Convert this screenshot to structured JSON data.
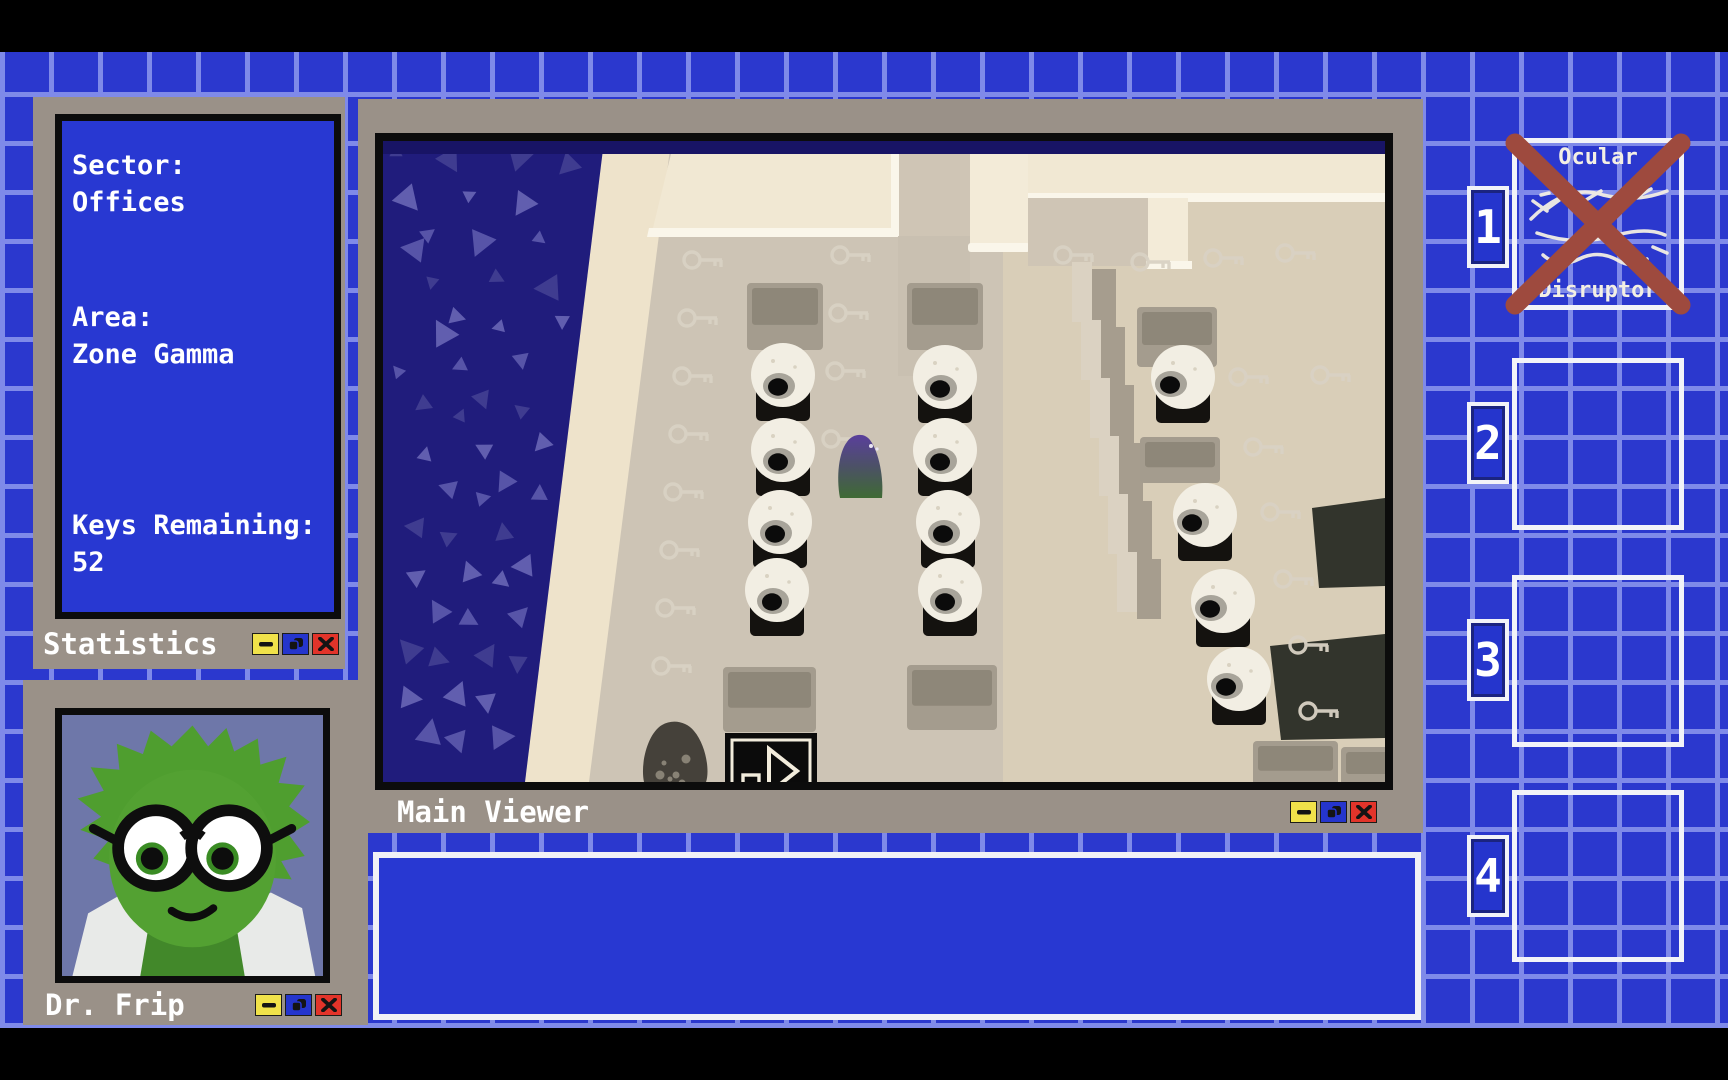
{
  "colors": {
    "grid_tile_blue": "#2b38ce",
    "grid_line_blue": "#7f8ae9",
    "window_frame_gray": "#9a9188",
    "panel_blue": "#2838d2",
    "button_yellow": "#f0e24a",
    "button_blue": "#2535cd",
    "button_red": "#e2342a",
    "crossout_red": "#9e4a3e",
    "portrait_background": "#6e77a9"
  },
  "windows": {
    "statistics": {
      "title": "Statistics",
      "fields": [
        {
          "label": "Sector:",
          "value": "Offices"
        },
        {
          "label": "Area:",
          "value": "Zone Gamma"
        },
        {
          "label": "Keys Remaining:",
          "value": "52"
        }
      ]
    },
    "portrait": {
      "title": "Dr. Frip"
    },
    "viewer": {
      "title": "Main Viewer"
    },
    "message": {
      "text": ""
    }
  },
  "window_controls": {
    "minimize": "—",
    "restore": "❐",
    "close": "✕"
  },
  "inventory": {
    "slots": [
      {
        "number": "1",
        "item": {
          "name": "Ocular Disruptor",
          "line1": "Ocular",
          "line2": "Disruptor",
          "crossed_out": true
        }
      },
      {
        "number": "2",
        "item": null
      },
      {
        "number": "3",
        "item": null
      },
      {
        "number": "4",
        "item": null
      }
    ]
  },
  "scene": {
    "eyeballs": [
      {
        "x": 400,
        "y": 234,
        "look": "down"
      },
      {
        "x": 400,
        "y": 309,
        "look": "down"
      },
      {
        "x": 397,
        "y": 381,
        "look": "down"
      },
      {
        "x": 394,
        "y": 449,
        "look": "down"
      },
      {
        "x": 562,
        "y": 236,
        "look": "down"
      },
      {
        "x": 562,
        "y": 309,
        "look": "down"
      },
      {
        "x": 565,
        "y": 381,
        "look": "down"
      },
      {
        "x": 567,
        "y": 449,
        "look": "down"
      },
      {
        "x": 800,
        "y": 236,
        "look": "left"
      },
      {
        "x": 822,
        "y": 374,
        "look": "left"
      },
      {
        "x": 840,
        "y": 460,
        "look": "left"
      },
      {
        "x": 856,
        "y": 538,
        "look": "left"
      }
    ],
    "keys": [
      {
        "x": 309,
        "y": 119
      },
      {
        "x": 304,
        "y": 177
      },
      {
        "x": 299,
        "y": 235
      },
      {
        "x": 295,
        "y": 293
      },
      {
        "x": 290,
        "y": 351
      },
      {
        "x": 286,
        "y": 409
      },
      {
        "x": 282,
        "y": 467
      },
      {
        "x": 278,
        "y": 525
      },
      {
        "x": 457,
        "y": 114
      },
      {
        "x": 455,
        "y": 172
      },
      {
        "x": 452,
        "y": 230
      },
      {
        "x": 448,
        "y": 298
      },
      {
        "x": 680,
        "y": 114
      },
      {
        "x": 757,
        "y": 121
      },
      {
        "x": 830,
        "y": 117
      },
      {
        "x": 902,
        "y": 112
      },
      {
        "x": 855,
        "y": 236
      },
      {
        "x": 937,
        "y": 234
      },
      {
        "x": 870,
        "y": 306
      },
      {
        "x": 887,
        "y": 371
      },
      {
        "x": 900,
        "y": 438
      },
      {
        "x": 915,
        "y": 504
      },
      {
        "x": 925,
        "y": 570
      }
    ],
    "mats": [
      {
        "x": 364,
        "y": 142,
        "w": 76,
        "h": 67
      },
      {
        "x": 524,
        "y": 142,
        "w": 76,
        "h": 67
      },
      {
        "x": 754,
        "y": 166,
        "w": 80,
        "h": 60
      },
      {
        "x": 757,
        "y": 296,
        "w": 80,
        "h": 46
      },
      {
        "x": 340,
        "y": 526,
        "w": 93,
        "h": 65
      },
      {
        "x": 524,
        "y": 524,
        "w": 90,
        "h": 65
      },
      {
        "x": 870,
        "y": 600,
        "w": 85,
        "h": 45
      },
      {
        "x": 958,
        "y": 606,
        "w": 60,
        "h": 40
      }
    ],
    "steps": [
      {
        "x": 700,
        "y": 128
      },
      {
        "x": 709,
        "y": 186
      },
      {
        "x": 718,
        "y": 244
      },
      {
        "x": 727,
        "y": 302
      },
      {
        "x": 736,
        "y": 360
      },
      {
        "x": 745,
        "y": 418
      }
    ],
    "desks": [
      {
        "points": "929,367 1002,357 1002,445 936,447"
      },
      {
        "points": "887,505 1002,493 1002,597 898,599"
      }
    ],
    "slime": {
      "x": 480,
      "y": 327
    },
    "shadow_blob": {
      "x": 293,
      "y": 612
    },
    "exit_sign": {
      "x": 342,
      "y": 592,
      "w": 92,
      "h": 74
    }
  }
}
